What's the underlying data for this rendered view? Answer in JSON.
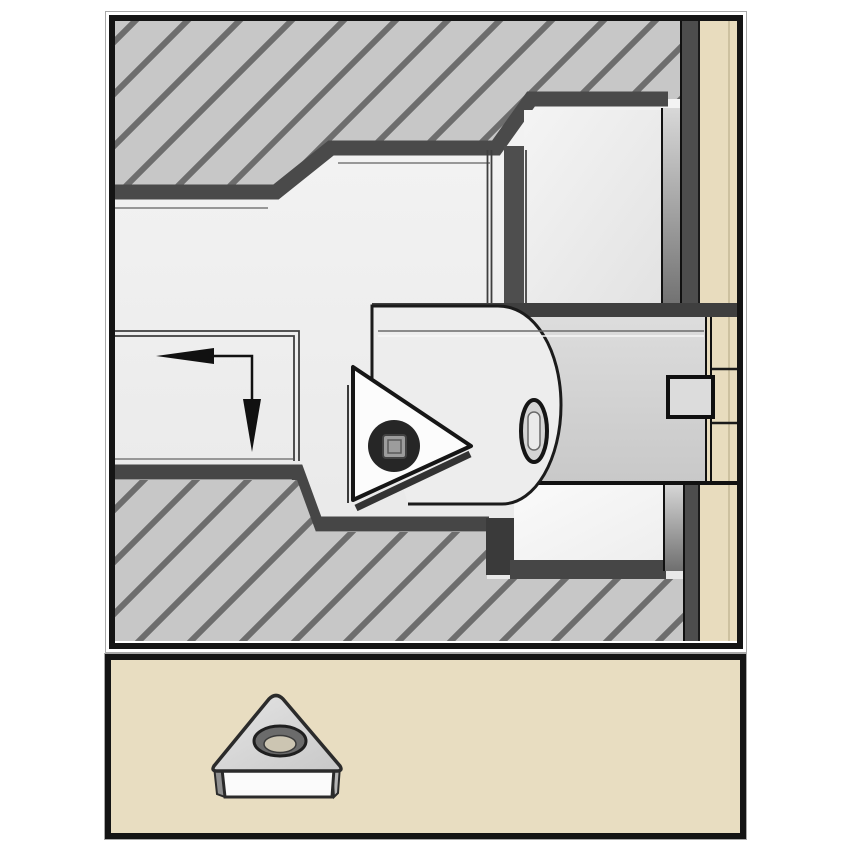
{
  "page": {
    "background": "#ffffff"
  },
  "colors": {
    "frame_border": "#141414",
    "outer_hairline": "#a8a8a8",
    "bore_light": "#f4f4f4",
    "bore_dark": "#e7e7e7",
    "hatch_base": "#c7c7c7",
    "hatch_stripe": "#6d6d6d",
    "wall_band": "#4a4a4a",
    "wall_band_soft": "#464646",
    "wall_highlight": "#979797",
    "thin_edge": "#3f3f3f",
    "shank_top_band": "#3f3f3f",
    "cartridge": "#ededed",
    "insert_face": "#fcfcfc",
    "insert_outline": "#161616",
    "screw_ring": "#262626",
    "screw_core": "#9c9c9c",
    "slot_fill": "#d4d4d4",
    "holder_tan": "#e8dcbe",
    "clamp_key": "#dcdcdc",
    "panel_tan": "#e8ddc1",
    "end_face": "#4d4d4d",
    "recess_left_wall": "#4e4e4e",
    "recess_left_wall_lower": "#3a3a3a",
    "icon_side": "#fbfbfb",
    "icon_left_sliver": "#8f8f8f",
    "icon_right_sliver": "#b5b5b5",
    "hole_ring": "#6b6b6b",
    "hole_core": "#ccc5b2",
    "arrow": "#111111",
    "outline": "#1b1b1b"
  },
  "main_scene": {
    "subject": "cross-section of workpiece bore machined by boring bar with triangular insert",
    "feed_arrow": {
      "directions": [
        "left",
        "down"
      ]
    },
    "insert": {
      "shape": "triangle",
      "tip_direction": "right",
      "center_screw": true
    },
    "workpiece": {
      "section_style": "diagonal-hatch",
      "features": [
        "stepped-bore",
        "internal-recess"
      ]
    },
    "holder": {
      "position": "right-strip",
      "clamp_key_notch": true
    }
  },
  "insert_panel": {
    "icon": "trigon-insert-icon",
    "view": "isometric",
    "center_hole": true
  }
}
